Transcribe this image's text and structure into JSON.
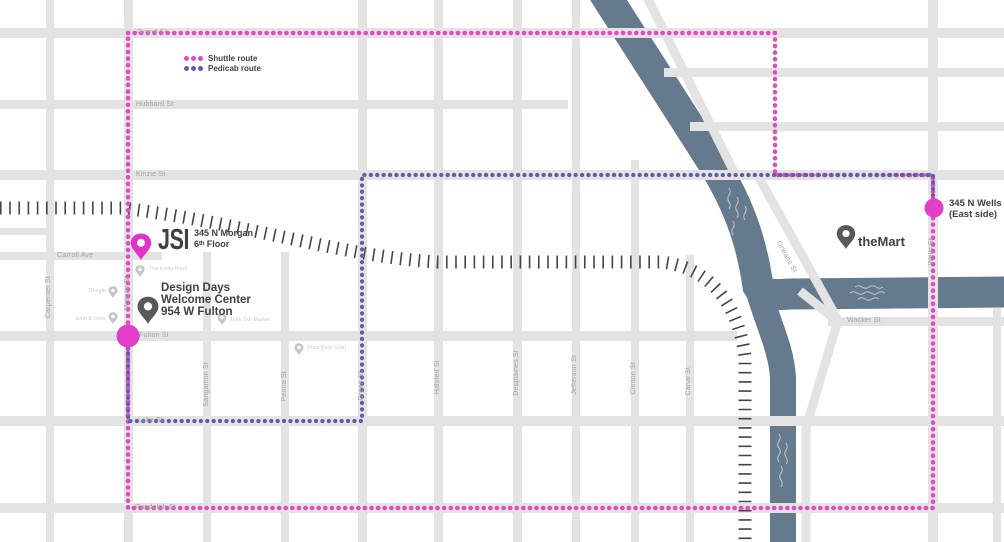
{
  "legend": {
    "shuttle_label": "Shuttle route",
    "pedicab_label": "Pedicab route"
  },
  "colors": {
    "shuttle_pink": "#e24bc4",
    "pedicab_blue": "#5d5ea9",
    "river_blue": "#657a8c",
    "street_gray": "#e3e3e3",
    "railroad_dark": "#454545",
    "street_label_gray": "#a2a2a2",
    "poi_gray": "#c9c9c9",
    "text_dark": "#3f4043"
  },
  "markers": {
    "jsi": {
      "title": "JSI",
      "line1": "345 N Morgan",
      "line2": "6ᵗʰ Floor"
    },
    "welcome_center": {
      "line1": "Design Days",
      "line2": "Welcome Center",
      "line3": "954 W Fulton"
    },
    "themart": {
      "title": "theMart"
    },
    "wells_stop": {
      "line1": "345 N Wells",
      "line2": "(East side)"
    }
  },
  "streets": {
    "grand": "Grand St",
    "hubbard": "Hubbard St",
    "kinzie": "Kinzie St",
    "carroll": "Carroll Ave",
    "fulton": "Fulton St",
    "lake": "Lake St",
    "randolph": "Randolph St",
    "wacker": "Wacker St",
    "carpenter": "Carpenter St",
    "morgan": "Morgan St",
    "sangamon": "Sangamon St",
    "peoria": "Peoria St",
    "green": "Green St",
    "halsted": "Halsted St",
    "desplaines": "Desplaines St",
    "jefferson": "Jefferson St",
    "clinton": "Clinton St",
    "canal": "Canal St",
    "wells": "Wells St",
    "orleans": "Orleans St"
  },
  "pois": {
    "emily_hotel": "The Emily Hotel",
    "google": "Google",
    "swift_sons": "Swift & Sons",
    "time_out": "Time Out Market",
    "duck_duck_goat": "Duck Duck Goat"
  }
}
